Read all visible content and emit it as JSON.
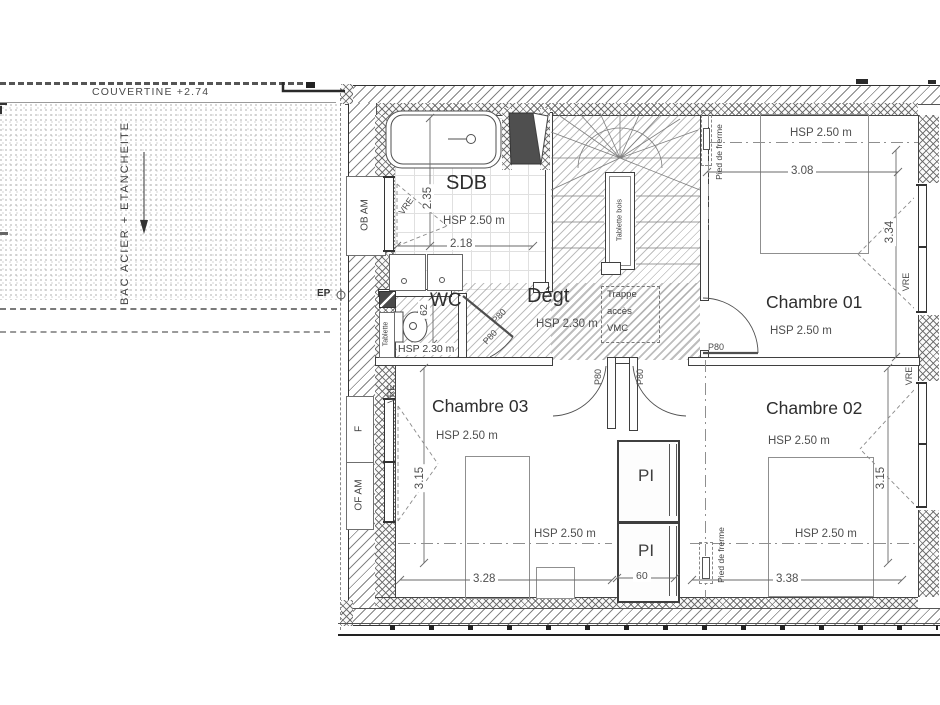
{
  "roof": {
    "couvertine": "COUVERTINE +2.74",
    "surface": "BAC ACIER + ETANCHEITE",
    "ep": "EP"
  },
  "sdb": {
    "name": "SDB",
    "hsp": "HSP 2.50 m",
    "width": "2.18",
    "depth": "2.35",
    "window": "OB AM",
    "vre": "VRE"
  },
  "wc": {
    "name": "WC",
    "hsp": "HSP 2.30 m",
    "dim": "62",
    "shelf": "Tablette",
    "door": "P80",
    "door2": "P80"
  },
  "degt": {
    "name": "Dégt",
    "hsp": "HSP 2.30 m",
    "trappe1": "Trappe",
    "trappe2": "accès",
    "trappe3": "VMC"
  },
  "stairs": {
    "shelf": "Tablette bois"
  },
  "ch1": {
    "name": "Chambre 01",
    "hsp_top": "HSP 2.50 m",
    "hsp": "HSP 2.50 m",
    "width": "3.08",
    "depth": "3.34",
    "door": "P80",
    "truss": "Pied de frerme",
    "vre": "VRE"
  },
  "ch2": {
    "name": "Chambre 02",
    "hsp_top": "HSP 2.50 m",
    "hsp": "HSP 2.50 m",
    "width": "3.38",
    "depth": "3.15",
    "truss": "Pied de frerme",
    "vre": "VRE"
  },
  "ch3": {
    "name": "Chambre 03",
    "hsp_top": "HSP 2.50 m",
    "hsp": "HSP 2.50 m",
    "width": "3.28",
    "depth": "3.15",
    "vre": "VRE",
    "window_f": "F",
    "window_of": "OF AM"
  },
  "pi": {
    "top": "PI",
    "bottom": "PI",
    "width": "60",
    "door_left": "P80",
    "door_right": "P80"
  }
}
